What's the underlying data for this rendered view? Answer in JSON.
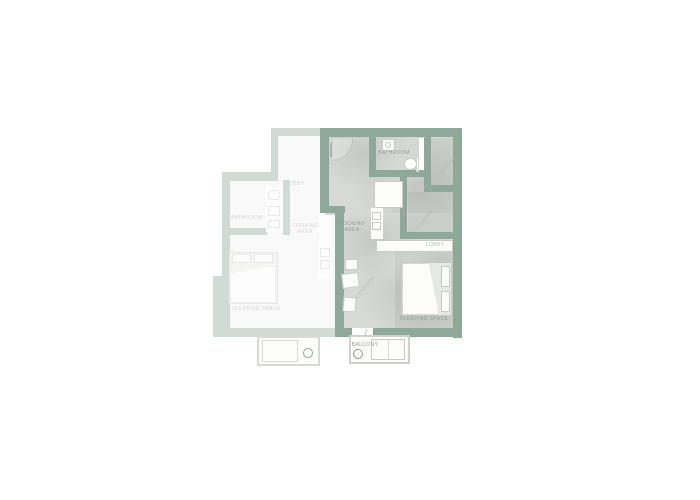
{
  "plan": {
    "unit_right": {
      "labels": {
        "bathroom": "BATHROOM",
        "wardrobe": "WARDROBE",
        "storage": "STORAGE",
        "lobby": "LOBBY",
        "cooking_line1": "COOKING",
        "cooking_line2": "AREA",
        "corridor": "CORRIDOR",
        "sleeping": "SLEEPING SPACE",
        "balcony": "BALCONY"
      }
    },
    "unit_left": {
      "labels": {
        "lobby": "LOBBY",
        "bathroom": "BATHROOM",
        "cooking_line1": "COOKING",
        "cooking_line2": "AREA",
        "sleeping": "SLEEPING SPACE"
      }
    },
    "colors": {
      "wall": "#8ea89a",
      "wall_faded": "#ccd8cf",
      "floor": "#d7d9d6",
      "floor_faded": "#eff1ef",
      "label": "#949e98",
      "label_faint": "#b6bdb7",
      "furniture_border": "#c9cbc8",
      "background": "#ffffff"
    }
  }
}
